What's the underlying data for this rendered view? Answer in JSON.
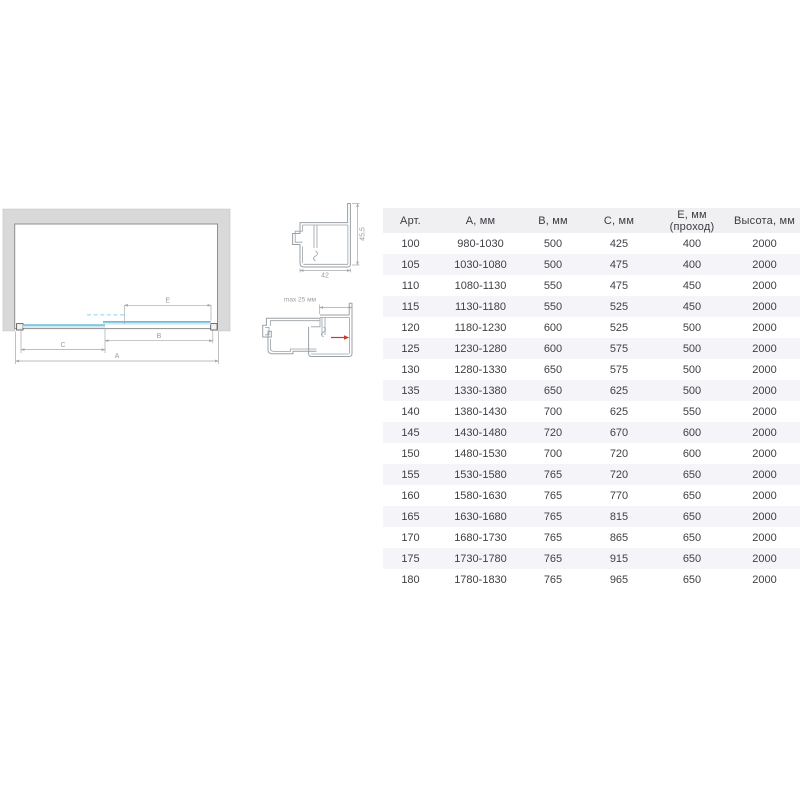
{
  "diagram": {
    "dim_labels": {
      "a": "A",
      "b": "B",
      "c": "C",
      "e": "E"
    },
    "profile_top": {
      "width": "42",
      "height": "45,5"
    },
    "profile_adjust": {
      "max": "max 25 мм"
    },
    "colors": {
      "glass_edge": "#55b2d7",
      "glass_fill": "#cde9f3",
      "glass_dashed": "#b5e2ee",
      "wall_fill": "#d9d9d9",
      "outline": "#8f8f8f",
      "dim_line": "#a8a8a8",
      "dim_label": "#9c9c9c",
      "profile_stroke": "#9aa1a6",
      "arrow_red": "#cc3a2c"
    }
  },
  "table": {
    "columns": [
      "Арт.",
      "А, мм",
      "В, мм",
      "С, мм",
      "Е, мм (проход)",
      "Высота, мм"
    ],
    "rows": [
      [
        "100",
        "980-1030",
        "500",
        "425",
        "400",
        "2000"
      ],
      [
        "105",
        "1030-1080",
        "500",
        "475",
        "400",
        "2000"
      ],
      [
        "110",
        "1080-1130",
        "550",
        "475",
        "450",
        "2000"
      ],
      [
        "115",
        "1130-1180",
        "550",
        "525",
        "450",
        "2000"
      ],
      [
        "120",
        "1180-1230",
        "600",
        "525",
        "500",
        "2000"
      ],
      [
        "125",
        "1230-1280",
        "600",
        "575",
        "500",
        "2000"
      ],
      [
        "130",
        "1280-1330",
        "650",
        "575",
        "500",
        "2000"
      ],
      [
        "135",
        "1330-1380",
        "650",
        "625",
        "500",
        "2000"
      ],
      [
        "140",
        "1380-1430",
        "700",
        "625",
        "550",
        "2000"
      ],
      [
        "145",
        "1430-1480",
        "720",
        "670",
        "600",
        "2000"
      ],
      [
        "150",
        "1480-1530",
        "700",
        "720",
        "600",
        "2000"
      ],
      [
        "155",
        "1530-1580",
        "765",
        "720",
        "650",
        "2000"
      ],
      [
        "160",
        "1580-1630",
        "765",
        "770",
        "650",
        "2000"
      ],
      [
        "165",
        "1630-1680",
        "765",
        "815",
        "650",
        "2000"
      ],
      [
        "170",
        "1680-1730",
        "765",
        "865",
        "650",
        "2000"
      ],
      [
        "175",
        "1730-1780",
        "765",
        "915",
        "650",
        "2000"
      ],
      [
        "180",
        "1780-1830",
        "765",
        "965",
        "650",
        "2000"
      ]
    ]
  }
}
